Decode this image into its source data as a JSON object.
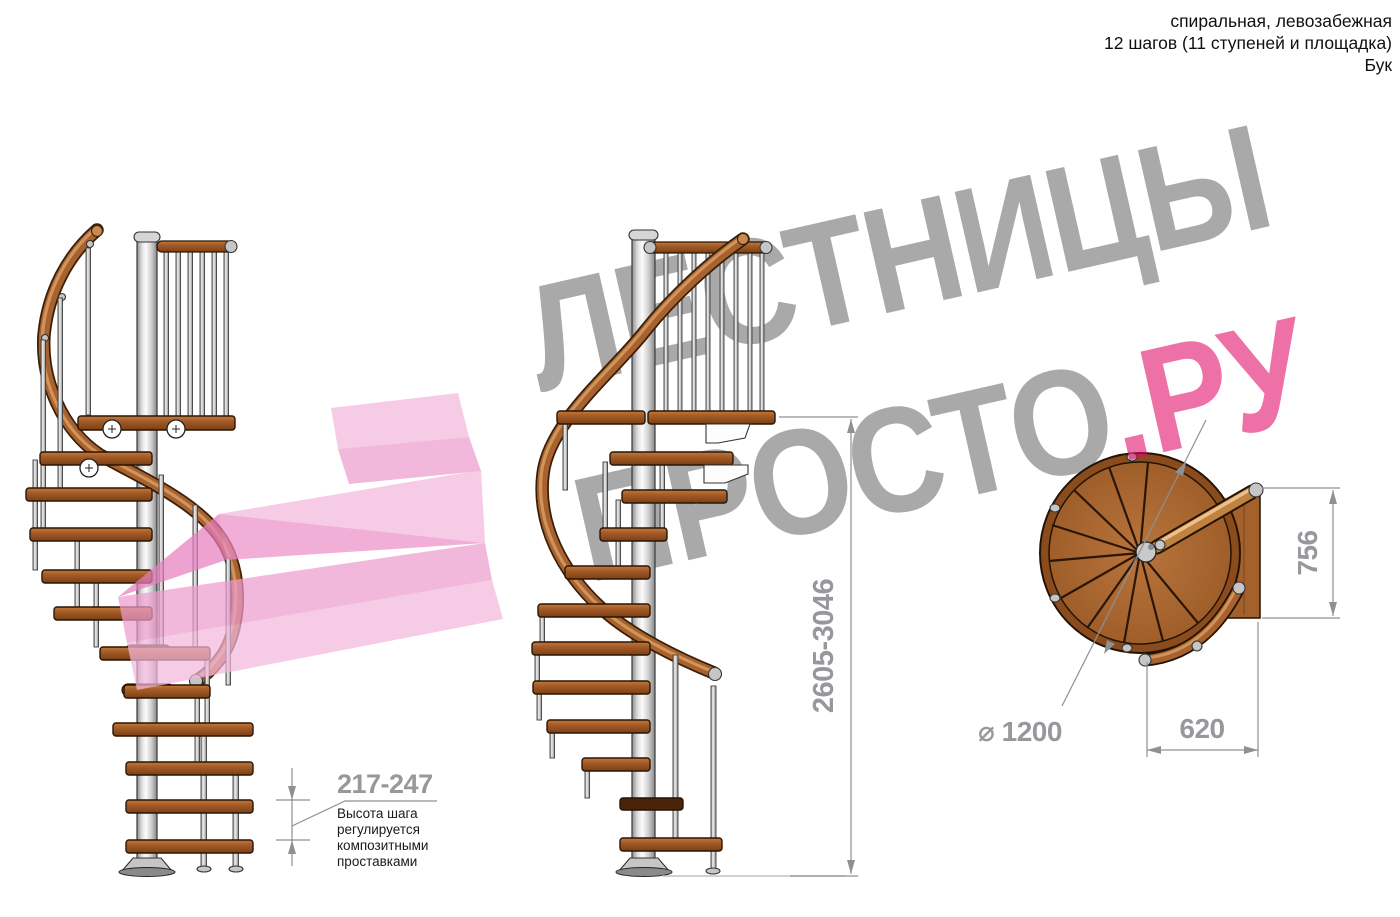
{
  "header": {
    "line1": "спиральная, левозабежная",
    "line2": "12 шагов (11 ступеней и площадка)",
    "line3": "Бук"
  },
  "watermark": {
    "word1": "ЛЕСТНИЦЫ",
    "word2": "ПРОСТО",
    "suffix": ".РУ",
    "gray_color": "#a9a9a9",
    "pink_color": "#ee74aa",
    "overlay_pink": "#f2b8dc"
  },
  "dimensions": {
    "step_height": {
      "value": "217-247",
      "note_lines": [
        "Высота шага",
        "регулируется",
        "композитными",
        "проставками"
      ]
    },
    "total_height": "2605-3046",
    "platform_depth": "756",
    "landing_width": "620",
    "diameter": "⌀ 1200"
  },
  "colors": {
    "wood": "#a5612c",
    "handrail": "#a8622f",
    "metal_pole": "#c9c9c9",
    "dimension_gray": "#8f9093",
    "text_black": "#101010"
  }
}
